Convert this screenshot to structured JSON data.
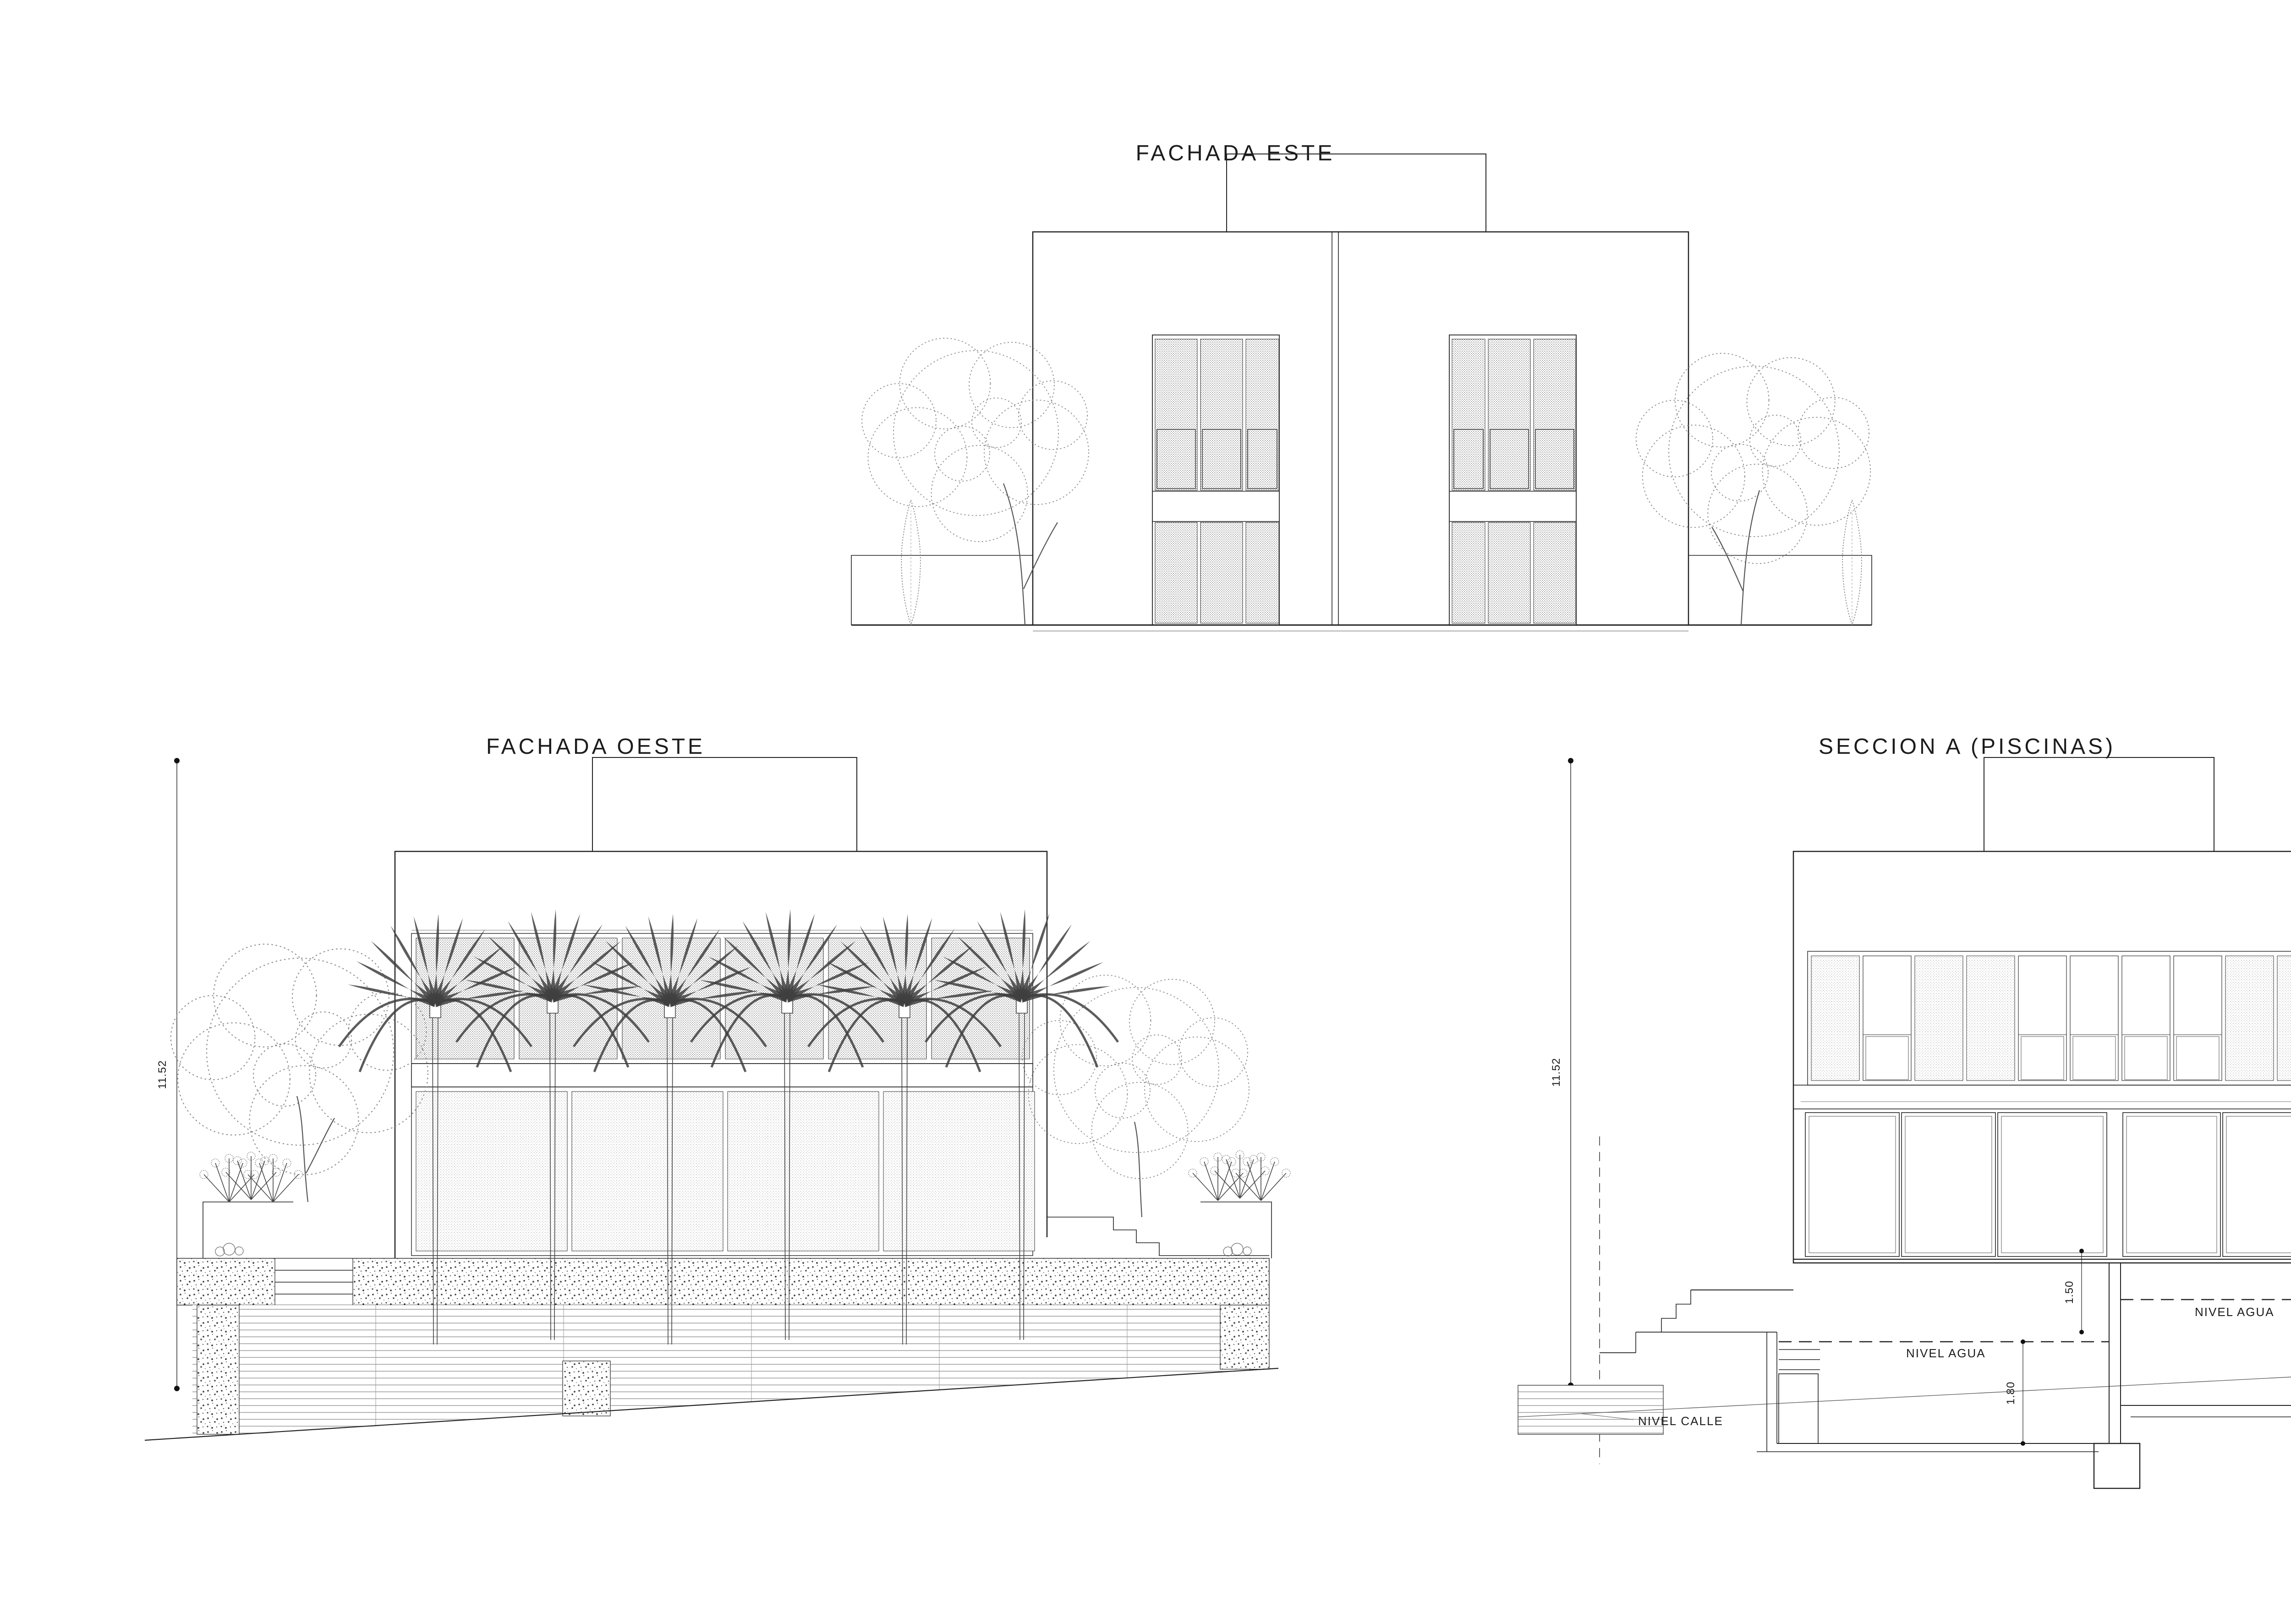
{
  "titles": {
    "este": "FACHADA ESTE",
    "oeste": "FACHADA OESTE",
    "seccion": "SECCION A (PISCINAS)"
  },
  "dimensions": {
    "oeste_height": "11.52",
    "seccion_height": "11.52",
    "seccion_floor_drop": "1.50",
    "seccion_pool_depth": "1.80"
  },
  "labels": {
    "nivel_agua": "NIVEL AGUA",
    "nivel_calle": "NIVEL CALLE"
  },
  "level_scale": [
    "125.00",
    "124.50",
    "124.00",
    "123.50",
    "123.00",
    "122.90",
    "122.80",
    "122.70",
    "122.60",
    "122.50",
    "122.40",
    "122.30",
    "122.20",
    "122.10",
    "122.00"
  ],
  "title_block": {
    "text": "FACHADAS ESTE Y OESTE. SECCION A"
  },
  "colors": {
    "line": "#222222",
    "line_light": "#777777",
    "foliage": "#3f3f3f"
  }
}
